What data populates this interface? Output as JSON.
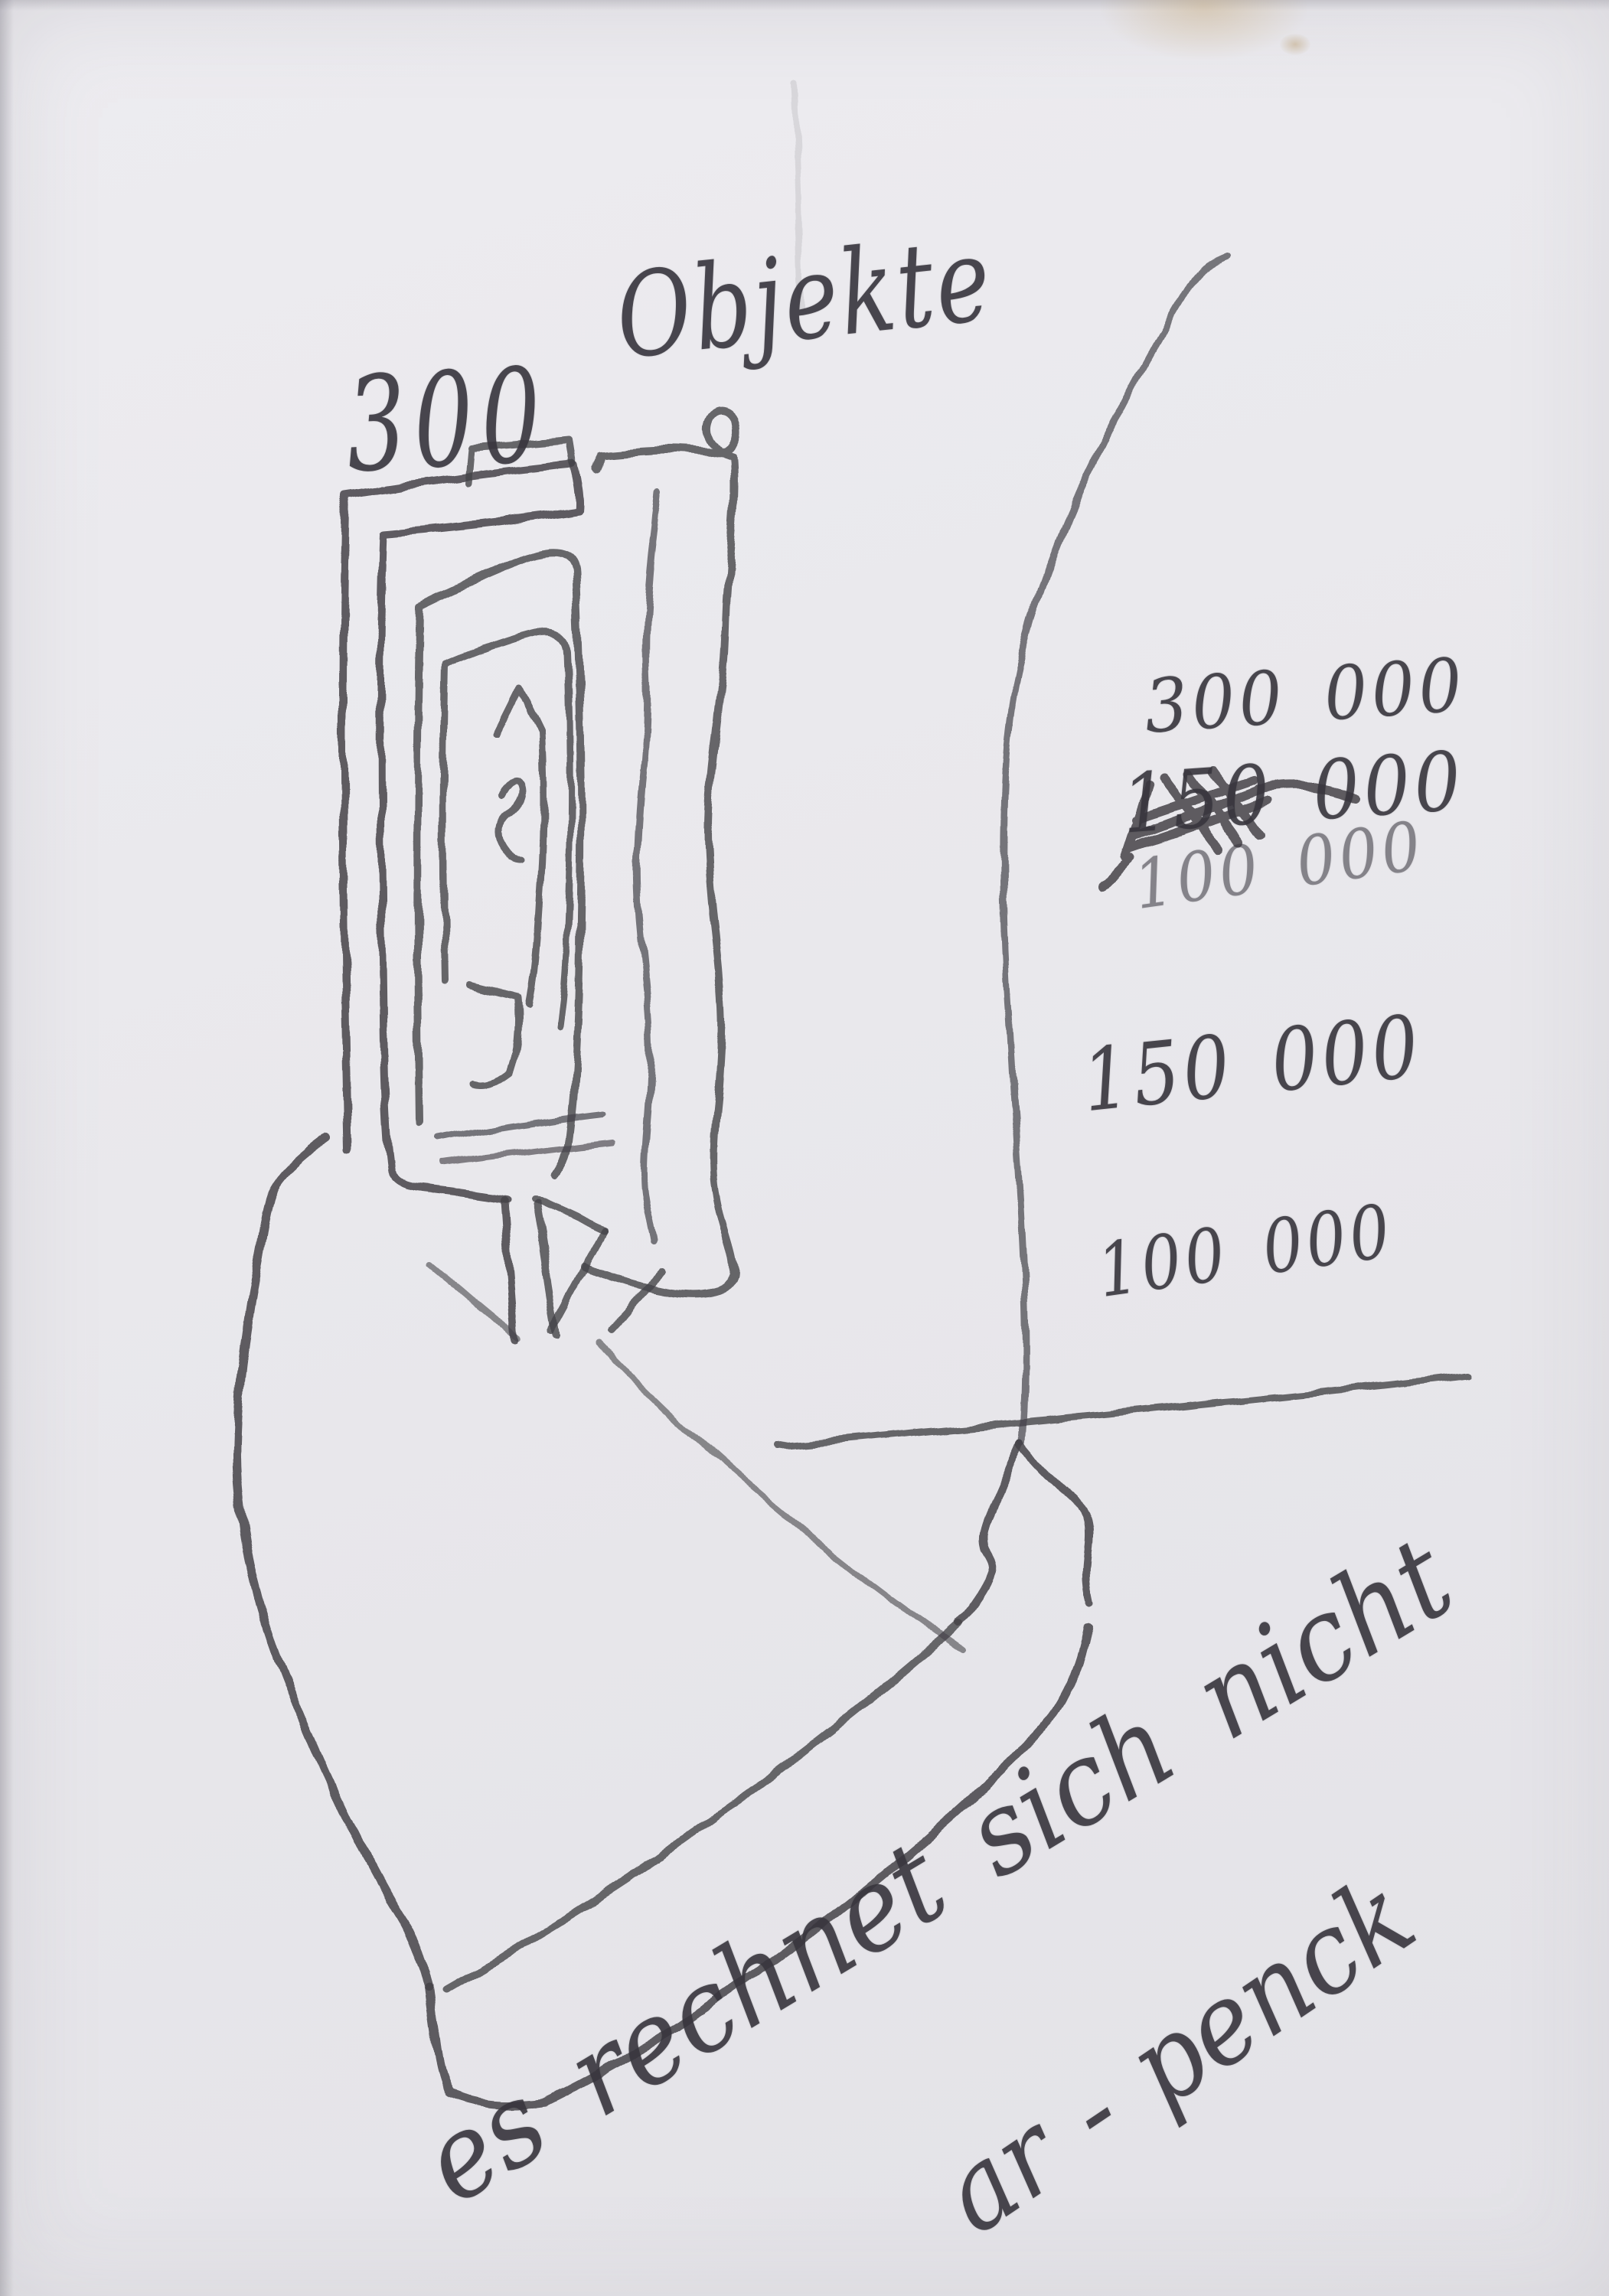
{
  "artwork": {
    "heading": {
      "count": "300",
      "word": "Objekte"
    },
    "amounts": [
      {
        "value": "300 000",
        "crossed_out": false
      },
      {
        "value": "150 000",
        "crossed_out": true
      },
      {
        "value": "100 000",
        "crossed_out": false
      },
      {
        "value": "150 000",
        "crossed_out": false
      },
      {
        "value": "100 000",
        "crossed_out": false
      }
    ],
    "note": "es rechnet sich nicht",
    "signature": "ar - penck",
    "colors": {
      "paper": "#e9e8ec",
      "pencil": "#454349",
      "stain": "#c8a876"
    }
  }
}
